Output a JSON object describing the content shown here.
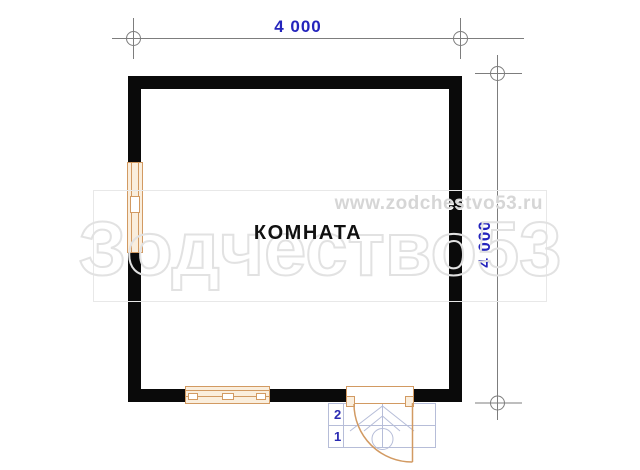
{
  "drawing": {
    "type": "floor-plan",
    "room": {
      "label": "КОМНАТА"
    },
    "dimensions": {
      "top_width": "4 000",
      "right_height": "4 000"
    },
    "porch": {
      "steps": [
        "2",
        "1"
      ]
    },
    "watermark": {
      "brand": "Зодчество53",
      "url": "www.zodchestvo53.ru"
    },
    "colors": {
      "wall": "#0a0a0a",
      "joinery_stroke": "#d29a62",
      "joinery_fill": "#faeedd",
      "dimension_line": "#7d7d7d",
      "dimension_text": "#2424bc",
      "porch_line": "#b6bdd8",
      "watermark_outline": "#e2e2e2",
      "watermark_url_text": "#d6d6d6",
      "background": "#ffffff"
    }
  }
}
